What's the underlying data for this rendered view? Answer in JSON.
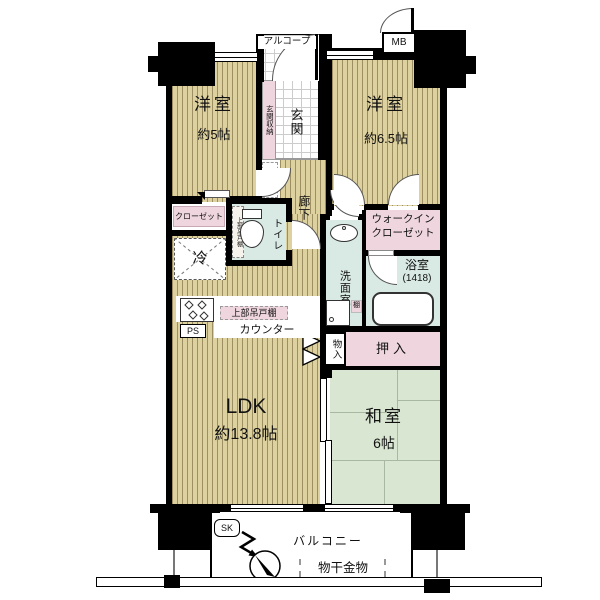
{
  "colors": {
    "wall": "#000000",
    "wood_floor": "#ddd1a0",
    "wood_line": "#9d8f61",
    "tatami_green": "#d9e6d2",
    "wet_area_teal": "#d9e9e4",
    "closet_pink": "#eed5de",
    "tile_line": "#cccccc"
  },
  "entry": {
    "alcove_label": "アルコープ",
    "mb_label": "MB",
    "genkan_label": "玄関",
    "genkan_storage_label": "玄関収納"
  },
  "rooms": {
    "west5": {
      "name": "洋室",
      "size": "約5帖"
    },
    "west65": {
      "name": "洋室",
      "size": "約6.5帖"
    },
    "corridor": {
      "name": "廊下"
    },
    "ldk": {
      "name": "LDK",
      "size": "約13.8帖"
    },
    "washitsu": {
      "name": "和室",
      "size": "6帖"
    },
    "toilet": {
      "name": "トイレ",
      "shelf": "上部吊戸棚"
    },
    "washroom": {
      "name": "洗面室"
    },
    "bath": {
      "name": "浴室",
      "size": "(1418)"
    },
    "wic": {
      "name_line1": "ウォークイン",
      "name_line2": "クローゼット"
    }
  },
  "storage": {
    "closet": "クローゼット",
    "oshiire": "押入",
    "monoire": "物入",
    "shelf": "棚"
  },
  "kitchen": {
    "hanging_cabinet": "上部吊戸棚",
    "counter": "カウンター",
    "fridge": "冷",
    "ps": "PS"
  },
  "balcony": {
    "name": "バルコニー",
    "drying_fixture": "物干金物",
    "slop_sink": "SK",
    "north": "N"
  }
}
